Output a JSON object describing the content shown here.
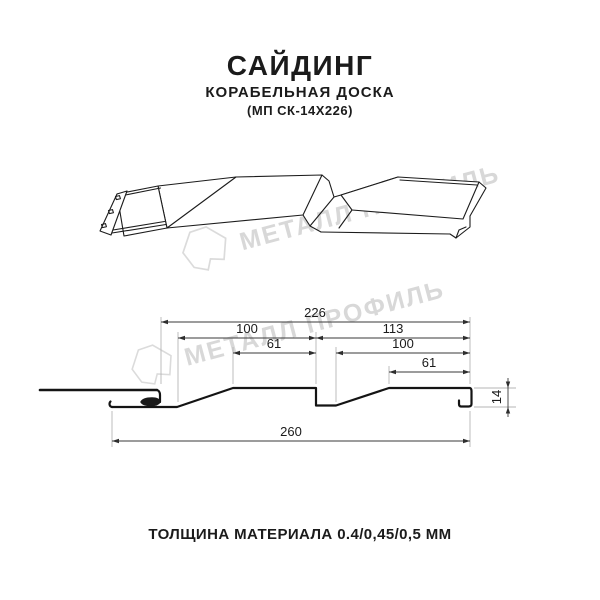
{
  "header": {
    "title": "САЙДИНГ",
    "subtitle": "КОРАБЕЛЬНАЯ ДОСКА",
    "model_code": "(МП СК-14Х226)"
  },
  "watermark": {
    "brand_text": "МЕТАЛЛ ПРОФИЛЬ",
    "color": "#d6d6d6"
  },
  "section_drawing": {
    "units": "mm",
    "dims": {
      "overall_top": "226",
      "left_module_width": "100",
      "right_module_width": "113",
      "left_top_flat": "61",
      "right_module_inner": "100",
      "right_top_flat": "61",
      "overall_bottom": "260",
      "profile_height": "14"
    }
  },
  "footer": {
    "thickness_note": "ТОЛЩИНА МАТЕРИАЛА 0.4/0,45/0,5 ММ"
  }
}
